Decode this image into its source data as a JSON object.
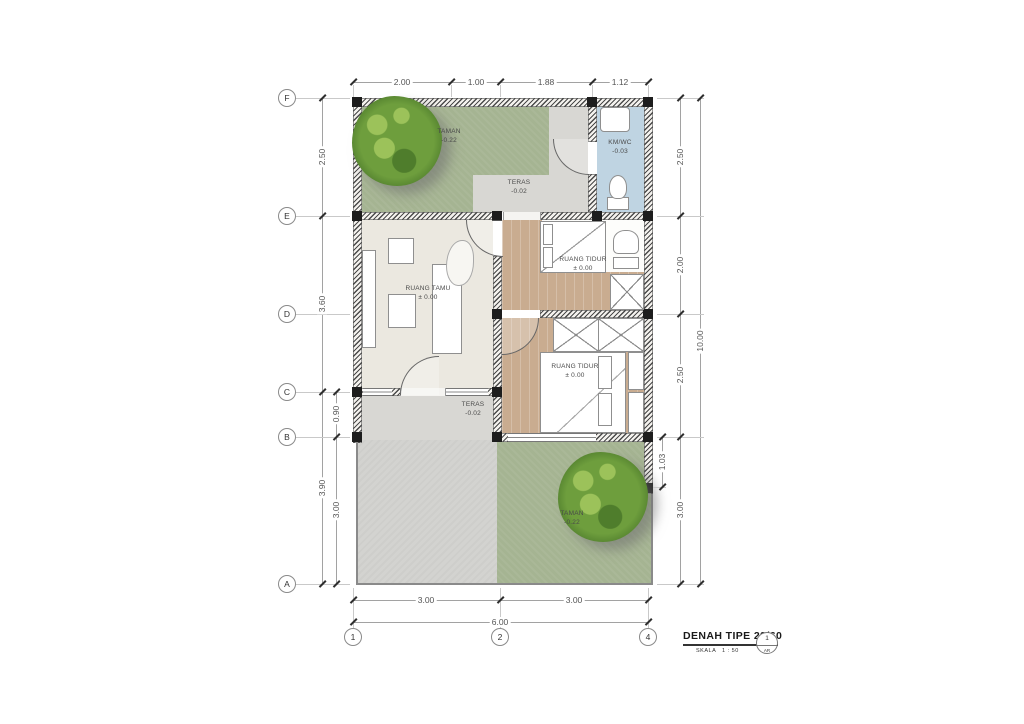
{
  "title_block": {
    "title": "DENAH TIPE 29/60",
    "scale_label": "SKALA",
    "scale_value": "1 : 50",
    "ref_number": "1",
    "ref_code": "AR"
  },
  "grid": {
    "rows": [
      "F",
      "E",
      "D",
      "C",
      "B",
      "A"
    ],
    "cols": [
      "1",
      "2",
      "4"
    ]
  },
  "dimensions": {
    "top": [
      "2.00",
      "1.00",
      "1.88",
      "1.12"
    ],
    "left_outer": [
      "2.50",
      "3.60",
      "3.90"
    ],
    "left_inner": [
      "0.90",
      "3.00"
    ],
    "right_inner": [
      "2.50",
      "2.00",
      "2.50",
      "3.00"
    ],
    "right_small": "1.03",
    "right_outer": "10.00",
    "bottom_inner": [
      "3.00",
      "3.00"
    ],
    "bottom_outer": "6.00"
  },
  "rooms": {
    "taman_back": {
      "name": "TAMAN",
      "level": "-0.22"
    },
    "kmwc": {
      "name": "KM/WC",
      "level": "-0.03"
    },
    "teras_back": {
      "name": "TERAS",
      "level": "-0.02"
    },
    "bedroom_1": {
      "name": "RUANG TIDUR",
      "level": "± 0.00"
    },
    "ruang_tamu": {
      "name": "RUANG TAMU",
      "level": "± 0.00"
    },
    "bedroom_2": {
      "name": "RUANG TIDUR",
      "level": "± 0.00"
    },
    "teras_front": {
      "name": "TERAS",
      "level": "-0.02"
    },
    "taman_front": {
      "name": "TAMAN",
      "level": "-0.22"
    }
  },
  "colors": {
    "garden_green": "#a5b492",
    "tree_green_dark": "#4f7d2c",
    "tree_green_mid": "#6e9e3d",
    "tree_green_light": "#9cc25a",
    "kmwc_blue": "#bfd4e2",
    "wood_floor": "#c9ac90",
    "teras_gray": "#d8d7d3",
    "drive_gray": "#d3d3d0",
    "living_cream": "#ebe8e0",
    "wall_dark": "#4a4a4a"
  }
}
